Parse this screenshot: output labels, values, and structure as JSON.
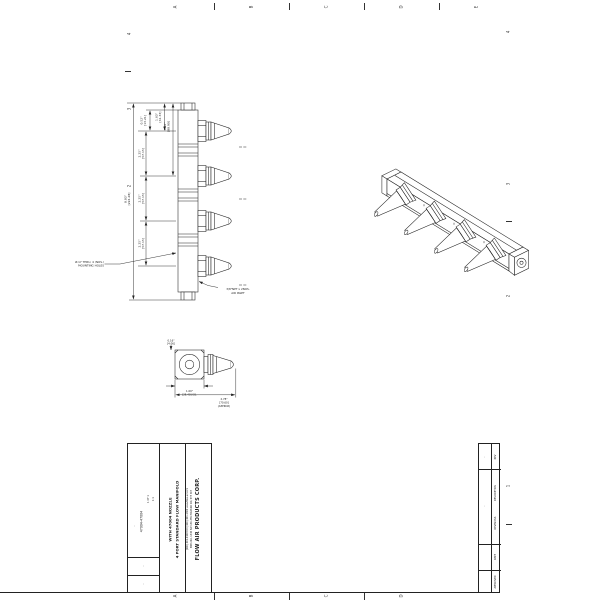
{
  "sheet": {
    "zones": {
      "top_letters": [
        "A",
        "B",
        "C",
        "D",
        "E"
      ],
      "bottom_letters": [
        "A",
        "B",
        "C",
        "D",
        "E"
      ],
      "left_numbers": [
        "4",
        "3",
        "2"
      ],
      "right_numbers": [
        "4",
        "3",
        "2",
        "1"
      ]
    }
  },
  "main_view": {
    "dims": {
      "cap_in": "0.52\"",
      "cap_mm": "[13.21]",
      "first_in": "1.63\"",
      "first_mm": "[41.33]",
      "second_in": "3.50\"",
      "second_mm": "[88.90]",
      "pitch_in": "2.25\"",
      "pitch_mm": "[57.15]",
      "overall_in": "8.83\"",
      "overall_mm": "[224.28]"
    },
    "notes": {
      "mounting_line1": "Ø.17 THRU, 4 (NOS.)",
      "mounting_line2": "MOUNTING HOLES",
      "inlet_line1": "3/8\"NPT x 2NOS.",
      "inlet_line2": "AIR INLET"
    }
  },
  "detail_view": {
    "dims": {
      "orifice_in": "0.16\"",
      "orifice_mm": "[4.06]",
      "square_in": "1.00\"",
      "square_mm": "[25.40] SQ.",
      "length_in": "2.78\"",
      "length_mm": "[70.60]",
      "length_approx": "(APPROX)"
    }
  },
  "title_block": {
    "company": "FLOW AIR PRODUCTS CORP.",
    "address_line1": "PMB 246, 1345 SW 130-355 HOWARD RD, STE 307",
    "address_line2": "(400) 401-0108  FAX (400) 401-1300  www.flow-air.com",
    "title_line1": "4 PORT STANDARD FLOW MANIFOLD",
    "title_line2": "WITH 47004 NOZZLE",
    "part_number": "47004-47004",
    "scale_label": "1:1",
    "sheet_label": "1 OF 1",
    "field_dash1": "-",
    "field_dash2": "-",
    "field_dash3": "-"
  },
  "revision_table": {
    "title": "REVISIONS",
    "headers": {
      "rev": "REV",
      "description": "DESCRIPTION",
      "date": "DATE",
      "approved": "APPROVED"
    },
    "values": {
      "rev": "-",
      "description": "-"
    }
  }
}
